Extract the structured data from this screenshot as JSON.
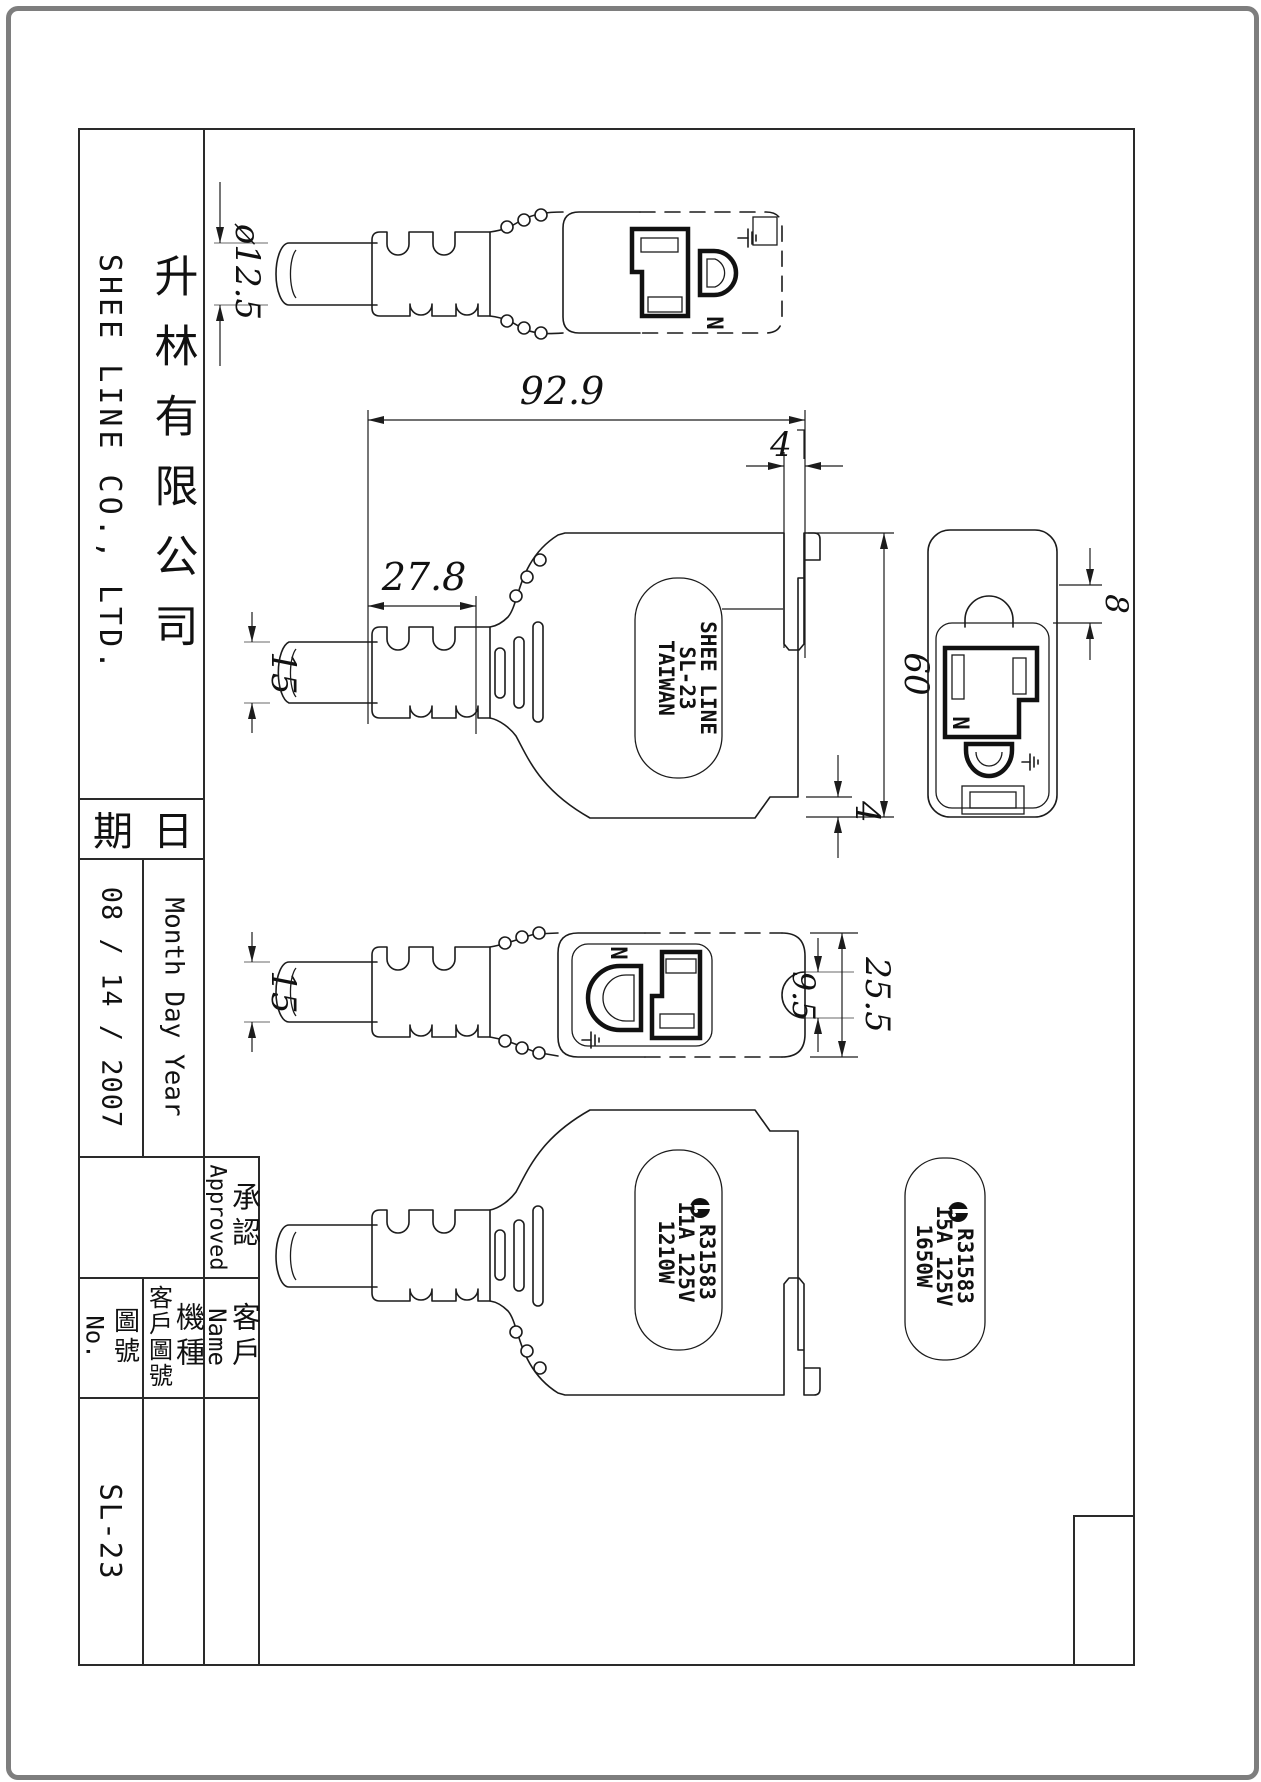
{
  "sheet": {
    "company_en": "SHEE LINE CO., LTD.",
    "company_zh": "升林有限公司",
    "date_label_right": "日",
    "date_label_left": "期",
    "date_format": "Month Day Year",
    "date_value": "08 / 14 / 2007",
    "approved_en": "Approved",
    "approved_zh": "承認",
    "name_en": "Name",
    "customer_zh": "客戶",
    "model_zh": "機種",
    "customer_drawing_zh": "客戶圖號",
    "drawing_no_en": "No.",
    "drawing_no_zh": "圖號",
    "part_number": "SL-23"
  },
  "views": {
    "top": {
      "dim_cable_diameter": "ø12.5",
      "neutral_label": "N"
    },
    "side": {
      "dim_total_length": "92.9",
      "dim_strain_relief": "27.8",
      "dim_cable_width": "15",
      "dim_top_notch": "4",
      "dim_body_height": "60",
      "dim_bottom_step": "4",
      "molded_label_line1": "SHEE LINE",
      "molded_label_line2": "SL-23",
      "molded_label_line3": "TAIWAN"
    },
    "front": {
      "dim_recess_offset": "8",
      "neutral_label": "N"
    },
    "back": {
      "dim_cable_width": "15",
      "dim_recess_diameter": "9.5",
      "dim_body_width": "25.5",
      "neutral_label": "N"
    },
    "bottom": {
      "rating_line1": "R31583",
      "rating_line2": "11A 125V",
      "rating_line3": "1210W"
    },
    "rating_label": {
      "line1": "R31583",
      "line2": "15A 125V",
      "line3": "1650W"
    }
  }
}
